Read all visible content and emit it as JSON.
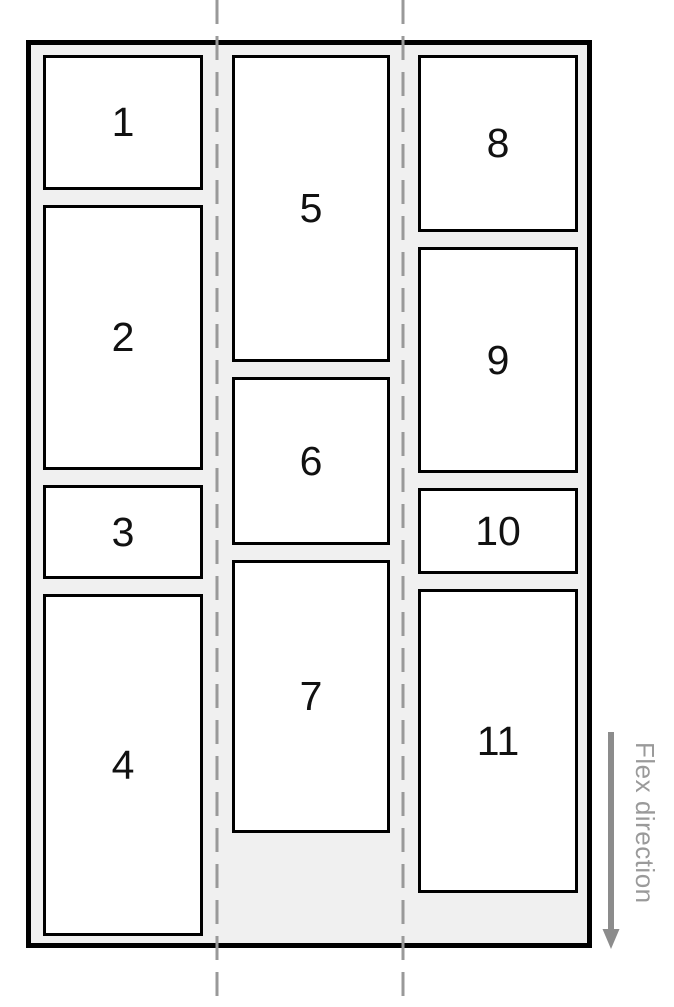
{
  "diagram": {
    "title": "flex-direction column wrap diagram",
    "flex_direction_label": "Flex direction",
    "columns": [
      {
        "items": [
          {
            "label": "1"
          },
          {
            "label": "2"
          },
          {
            "label": "3"
          },
          {
            "label": "4"
          }
        ]
      },
      {
        "items": [
          {
            "label": "5"
          },
          {
            "label": "6"
          },
          {
            "label": "7"
          }
        ]
      },
      {
        "items": [
          {
            "label": "8"
          },
          {
            "label": "9"
          },
          {
            "label": "10"
          },
          {
            "label": "11"
          }
        ]
      }
    ],
    "colors": {
      "container_bg": "#f0f0f0",
      "container_border": "#000000",
      "item_bg": "#ffffff",
      "item_border": "#000000",
      "guide_line": "#999999",
      "arrow": "#8c8c8c",
      "item_label_text": "#111111",
      "direction_label_text": "#9a9a9a"
    }
  }
}
